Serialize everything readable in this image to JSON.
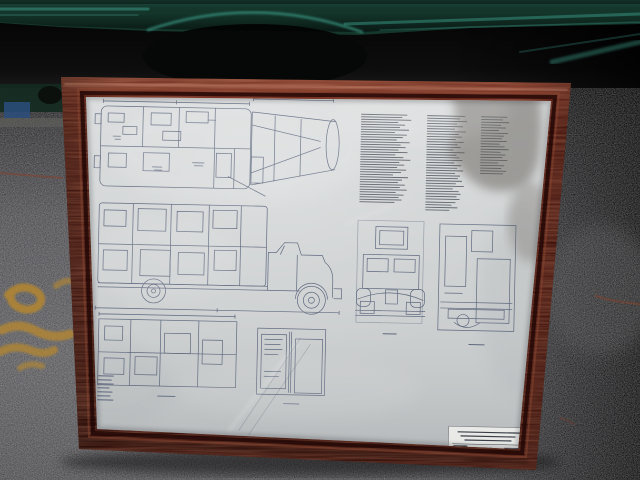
{
  "scene": {
    "type": "photograph",
    "subject": "Framed blueprint of a vintage truck leaning against a dark green vehicle on an asphalt lot",
    "frame_material": "dark mahogany wood frame",
    "artwork": "engineering drawing: top plan views, tapered boom detail, side elevation of truck with wheels, front elevation, rear elevation, lower plan and section details, three columns of fine specification text",
    "title_block": "small printed title block in lower-right corner of sheet (text too small to be legible)",
    "ground_markings": "yellow spray-painted squiggles on asphalt at lower left",
    "reflections": "glass glare streaks and a dark photographer silhouette reflected over upper-right of the sheet"
  },
  "colors": {
    "truck_green": "#14362b",
    "truck_green_highlight": "#37907d",
    "notch_shadow": "#050807",
    "asphalt": "#55555a",
    "paint_yellow": "#b9882b",
    "paint_red": "#8a4029",
    "frame_wood": "#5a1c13",
    "paper": "#cbcecf",
    "paper_bright": "#e9eae7",
    "ink": "#44506b",
    "ink_text": "#4e545e",
    "reflection_dark": "#635f58",
    "machinery_blue": "#2a4d7c"
  }
}
